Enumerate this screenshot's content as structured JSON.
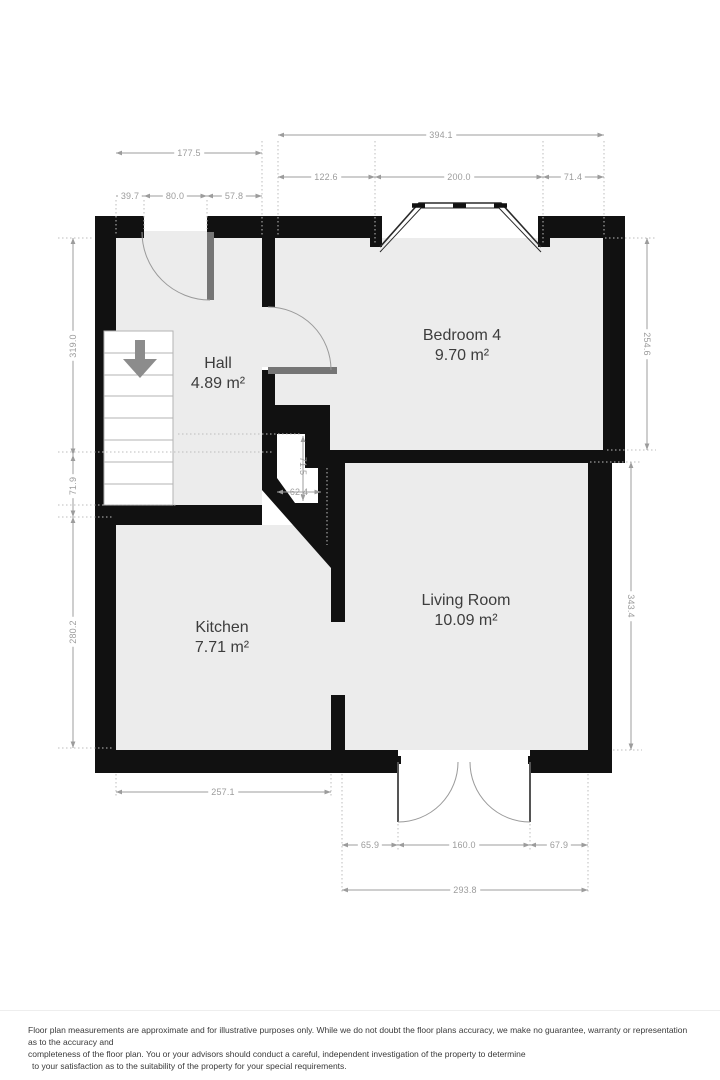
{
  "floorplan": {
    "wall_color": "#111111",
    "floor_color": "#ececec",
    "door_leaf_color": "#757575",
    "dimension_color": "#9c9c9c",
    "label_color": "#3d3d3d",
    "rooms": [
      {
        "id": "hall",
        "name": "Hall",
        "area": "4.89 m²"
      },
      {
        "id": "bedroom4",
        "name": "Bedroom 4",
        "area": "9.70 m²"
      },
      {
        "id": "kitchen",
        "name": "Kitchen",
        "area": "7.71 m²"
      },
      {
        "id": "living_room",
        "name": "Living Room",
        "area": "10.09 m²"
      }
    ],
    "dimensions": {
      "top_overall_right": "394.1",
      "top_overall_left": "177.5",
      "top_bay_left": "122.6",
      "top_bay": "200.0",
      "top_bay_right": "71.4",
      "top_entry_left": "39.7",
      "top_entry_door": "80.0",
      "top_entry_right": "57.8",
      "left_hall": "319.0",
      "left_mid": "71.9",
      "left_kitchen": "280.2",
      "right_bedroom": "254.6",
      "right_living": "343.4",
      "bottom_kitchen": "257.1",
      "bottom_living_left": "65.9",
      "bottom_doors": "160.0",
      "bottom_living_right": "67.9",
      "bottom_living_overall": "293.8",
      "cupboard_height": "71.5",
      "cupboard_width": "62.4"
    }
  },
  "footer": {
    "line1": "Floor plan measurements are approximate and for illustrative purposes only. While we do not doubt the floor plans accuracy, we make no guarantee, warranty or representation as to the accuracy and",
    "line2": "completeness of the floor plan. You or your advisors should conduct a careful, independent investigation of the property to determine",
    "line3": "to your satisfaction as to the suitability of the property for your special requirements."
  }
}
